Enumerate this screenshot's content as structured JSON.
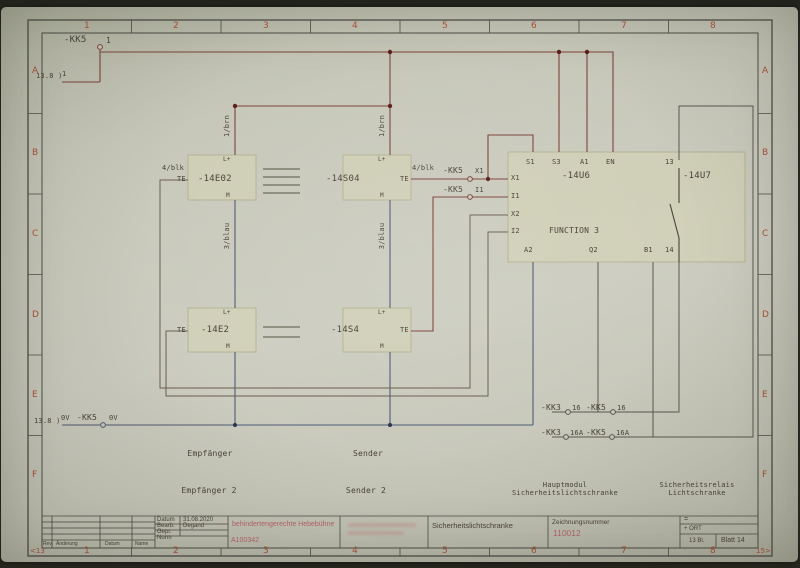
{
  "frame": {
    "columns": [
      "1",
      "2",
      "3",
      "4",
      "5",
      "6",
      "7",
      "8"
    ],
    "rows": [
      "A",
      "B",
      "C",
      "D",
      "E",
      "F"
    ],
    "prev_sheet": "<13",
    "next_sheet": "15>"
  },
  "net24": {
    "ref": "13.8 )",
    "ref_pin": "1",
    "conn": "-KK5",
    "pin": "1"
  },
  "net0v": {
    "ref": "13.8 )",
    "wire": "0V",
    "conn": "-KK5",
    "pin": "0V"
  },
  "wires": {
    "brn1": "1/brn",
    "brn2": "1/brn",
    "blau1": "3/blau",
    "blau2": "3/blau",
    "blk1": "4/blk",
    "blk2": "4/blk"
  },
  "plugs": {
    "x1_conn": "-KK5",
    "x1_pin": "X1",
    "i1_conn": "-KK5",
    "i1_pin": "I1",
    "p16a_conn": "-KK3",
    "p16a_pin": "16",
    "p16b_conn": "-KK5",
    "p16b_pin": "16",
    "p16aa_conn": "-KK3",
    "p16aa_pin": "16A",
    "p16ab_conn": "-KK5",
    "p16ab_pin": "16A"
  },
  "devices": {
    "e02": {
      "ref": "-14E02",
      "te": "TE",
      "lplus": "L+",
      "m": "M"
    },
    "s04": {
      "ref": "-14S04",
      "te": "TE",
      "lplus": "L+",
      "m": "M"
    },
    "e2": {
      "ref": "-14E2",
      "te": "TE",
      "lplus": "L+",
      "m": "M"
    },
    "s4": {
      "ref": "-14S4",
      "te": "TE",
      "lplus": "L+",
      "m": "M"
    },
    "u6": {
      "ref": "-14U6",
      "function": "FUNCTION 3",
      "s1": "S1",
      "s3": "S3",
      "a1": "A1",
      "en": "EN",
      "x1": "X1",
      "i1": "I1",
      "x2": "X2",
      "i2": "I2",
      "a2": "A2",
      "q2": "Q2",
      "b1": "B1"
    },
    "u7": {
      "ref": "-14U7",
      "t13": "13",
      "t14": "14"
    }
  },
  "captions": {
    "empfaenger": "Empfänger",
    "sender": "Sender",
    "empfaenger2": "Empfänger 2",
    "sender2": "Sender 2",
    "haupt1": "Hauptmodul",
    "haupt2": "Sicherheitslichtschranke",
    "relais1": "Sicherheitsrelais",
    "relais2": "Lichtschranke"
  },
  "titleblock": {
    "datum_label": "Datum",
    "datum_value": "31.08.2020",
    "bearb_label": "Bearb.",
    "bearb_value": "Degand",
    "gepr_label": "Gepr.",
    "norm_label": "Norm",
    "rev_label": "Rev.",
    "aenderung_label": "Änderung",
    "datum_col_label": "Datum",
    "name_col_label": "Name",
    "project": "behindertengerechte Hebebühne",
    "project_no": "A100342",
    "doc_title": "Sicherheitslichtschranke",
    "zeichnungsnummer_label": "Zeichnungsnummer",
    "zeichnungsnummer": "110012",
    "eq_label": "=",
    "ort_label": "+ ORT",
    "sheet_count": "13 Bl.",
    "sheet_label": "Blatt 14"
  },
  "colors": {
    "paper": "#c9cabc",
    "wire_red": "#7e4239",
    "wire_blue": "#4e5a74",
    "wire_gray": "#6b5f52",
    "wire_dark": "#5a5750",
    "accent_red": "#a85038",
    "pink": "#b5636a",
    "text": "#4a4238"
  }
}
